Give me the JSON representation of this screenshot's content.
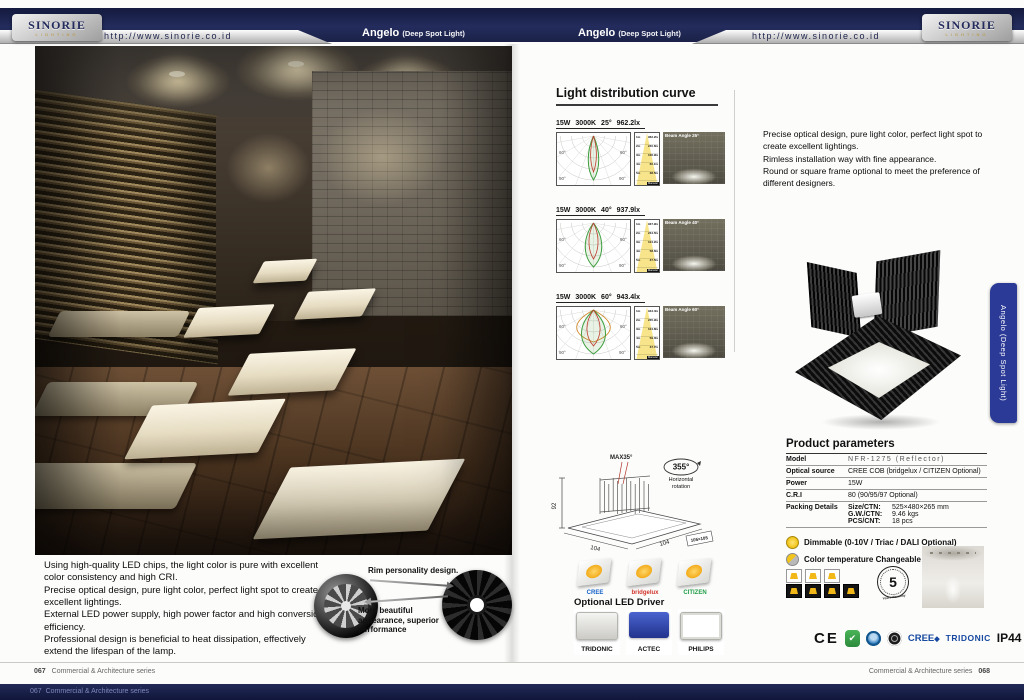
{
  "header": {
    "brand": "SINORIE",
    "brand_sub": "LIGHTING",
    "url": "http://www.sinorie.co.id",
    "product": "Angelo",
    "product_suffix": "(Deep Spot Light)"
  },
  "left_page": {
    "features": [
      "Using high-quality LED chips, the light color is pure with excellent color consistency and high CRI.",
      "Precise optical design, pure light color, perfect light spot to create excellent lightings.",
      "External LED power supply, high power factor and high conversion efficiency.",
      "Professional design is beneficial to heat dissipation, effectively extend the lifespan of the lamp."
    ],
    "rim": {
      "caption_top": "Rim personality design.",
      "caption_bottom": "More beautiful appearance, superior performance"
    }
  },
  "right_page": {
    "ldc": {
      "title": "Light distribution curve",
      "polar_labels": [
        "60°",
        "90°"
      ],
      "diameter_tag": "Diameter",
      "rows": [
        {
          "power": "15W",
          "cct": "3000K",
          "angle": "25°",
          "lux": "962.2lx",
          "beam": 25,
          "photo_label": "Beam Angle 25°",
          "cone": [
            [
              "1m",
              "962.2lx"
            ],
            [
              "2m",
              "240.6lx"
            ],
            [
              "3m",
              "106.9lx"
            ],
            [
              "4m",
              "60.1lx"
            ],
            [
              "5m",
              "38.5lx"
            ]
          ]
        },
        {
          "power": "15W",
          "cct": "3000K",
          "angle": "40°",
          "lux": "937.9lx",
          "beam": 40,
          "photo_label": "Beam Angle 40°",
          "cone": [
            [
              "1m",
              "937.9lx"
            ],
            [
              "2m",
              "234.5lx"
            ],
            [
              "3m",
              "104.2lx"
            ],
            [
              "4m",
              "58.6lx"
            ],
            [
              "5m",
              "37.5lx"
            ]
          ]
        },
        {
          "power": "15W",
          "cct": "3000K",
          "angle": "60°",
          "lux": "943.4lx",
          "beam": 60,
          "photo_label": "Beam Angle 60°",
          "cone": [
            [
              "1m",
              "943.4lx"
            ],
            [
              "2m",
              "235.9lx"
            ],
            [
              "3m",
              "104.8lx"
            ],
            [
              "4m",
              "59.0lx"
            ],
            [
              "5m",
              "37.7lx"
            ]
          ]
        }
      ]
    },
    "description": [
      "Precise optical design, pure light color, perfect light spot to create excellent lightings.",
      "Rimless installation way with fine appearance.",
      "Round or square frame optional to meet the preference of different designers."
    ],
    "side_tab": "Angelo (Deep Spot Light)",
    "params": {
      "title": "Product parameters",
      "rows": [
        {
          "label": "Model",
          "value": "NFR-1275  (Reflector)",
          "style": "model"
        },
        {
          "label": "Optical source",
          "value": "CREE COB (bridgelux / CITIZEN Optional)"
        },
        {
          "label": "Power",
          "value": "15W"
        },
        {
          "label": "C.R.I",
          "value": "80 (90/95/97 Optional)"
        },
        {
          "label": "Packing Details",
          "lines": [
            [
              "Size/CTN:",
              "525×480×265 mm"
            ],
            [
              "G.W./CTN:",
              "9.46 kgs"
            ],
            [
              "PCS/CNT:",
              "18 pcs"
            ]
          ]
        }
      ]
    },
    "dimmable": "Dimmable (0-10V / Triac / DALI Optional)",
    "cct_changeable": "Color temperature Changeable",
    "cct_icons": {
      "top": 3,
      "bottom": 4
    },
    "warranty": {
      "number": "5",
      "label": "Years Warranty"
    },
    "dims": {
      "tilt": "MAX35°",
      "rotation": "355°",
      "rotation_label1": "Horizontal",
      "rotation_label2": "rotation",
      "height": "92",
      "width": "104",
      "depth": "104",
      "cutout": "105×105"
    },
    "chips": [
      {
        "label": "CREE",
        "color": "#1461c8"
      },
      {
        "label": "bridgelux",
        "color": "#d0342b"
      },
      {
        "label": "CITIZEN",
        "color": "#1f9e46"
      }
    ],
    "driver_title": "Optional LED Driver",
    "drivers": [
      "TRIDONIC",
      "ACTEC",
      "PHILIPS"
    ],
    "certs": {
      "ce": "CE",
      "rohs_glyph": "✔",
      "cree": "CREE",
      "cree_mark": "◆",
      "tridonic": "TRIDONIC",
      "ip": "IP44"
    }
  },
  "footer": {
    "left_num": "067",
    "right_num": "068",
    "series": "Commercial & Architecture series"
  }
}
